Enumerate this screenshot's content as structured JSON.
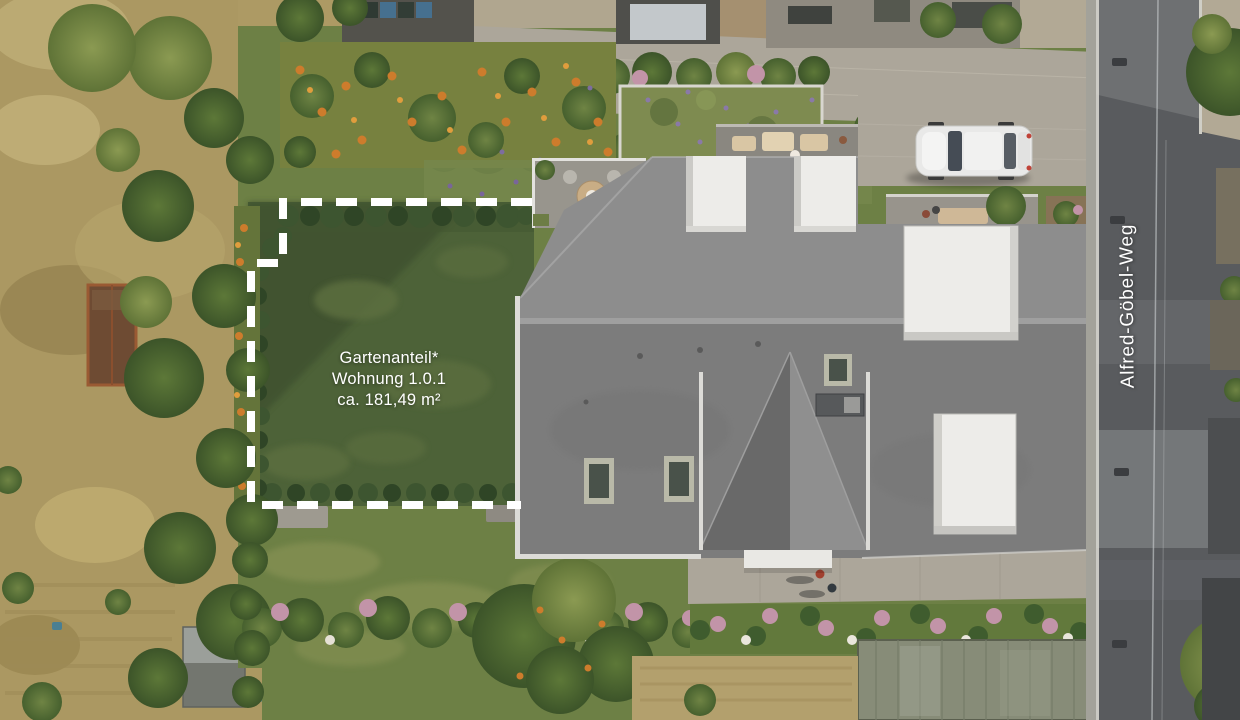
{
  "scene": {
    "type": "aerial-property-visualization",
    "labels": {
      "garden_area": {
        "line1": "Gartenanteil*",
        "line2": "Wohnung 1.0.1",
        "line3": "ca. 181,49 m²"
      },
      "street": "Alfred-Göbel-Weg"
    },
    "colors": {
      "label_text": "#ffffff",
      "boundary_dash": "#ffffff",
      "lawn_dark": "#4d6238",
      "lawn_light": "#6d8045",
      "roof_north": "#8d8d8d",
      "roof_south": "#7c7c7c",
      "roof_wing_shade": "#696969",
      "roof_wing_light": "#8f8f8f",
      "dormer_white": "#edece9",
      "road_asphalt": "#595b5e",
      "paver_gray": "#aca69a",
      "dry_grass": "#ab9862",
      "hedge_green": "#3d5530",
      "tree_green": "#55703a",
      "flower_orange": "#cd7c2c",
      "flower_pink": "#c294a8",
      "soil_brown": "#8a7158",
      "greenhouse_gray": "#878c78",
      "car_white": "#e9e9e8"
    }
  }
}
